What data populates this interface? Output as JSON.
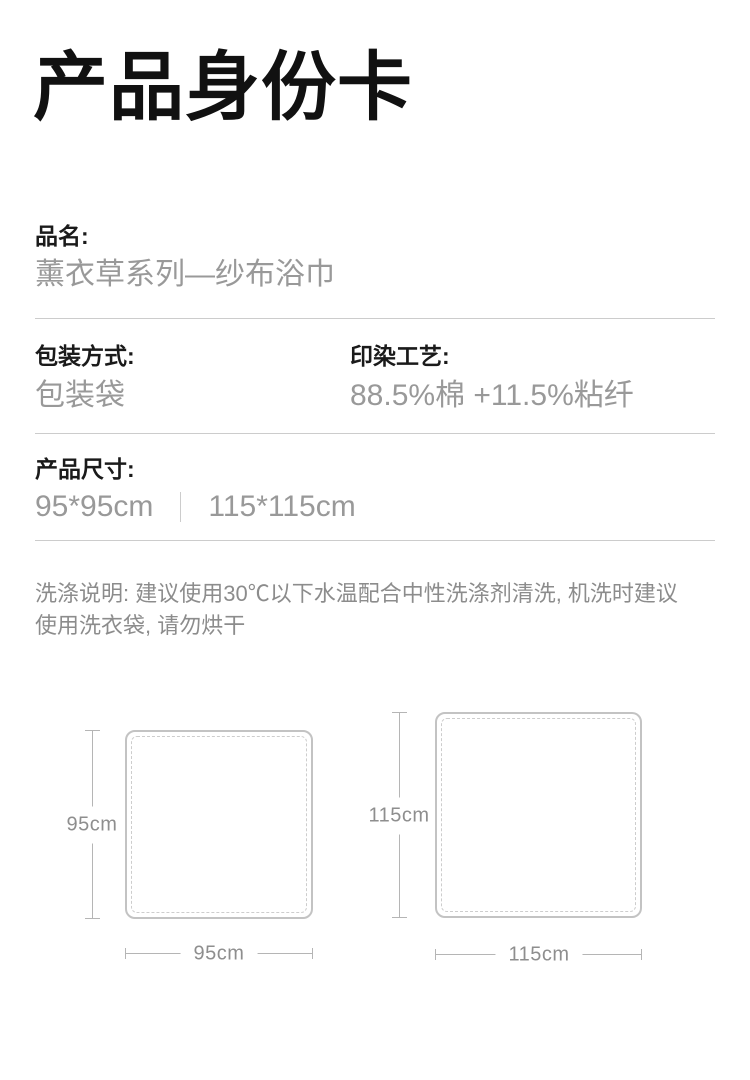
{
  "title": "产品身份卡",
  "fields": {
    "name": {
      "label": "品名:",
      "value": "薰衣草系列—纱布浴巾"
    },
    "packaging": {
      "label": "包装方式:",
      "value": "包装袋"
    },
    "dyeing": {
      "label": "印染工艺:",
      "value": "88.5%棉 +11.5%粘纤"
    },
    "size": {
      "label": "产品尺寸:",
      "value_small": "95*95cm",
      "value_large": "115*115cm"
    }
  },
  "care_note": {
    "line1": "洗涤说明: 建议使用30℃以下水温配合中性洗涤剂清洗, 机洗时建议",
    "line2": "使用洗衣袋, 请勿烘干"
  },
  "diagrams": [
    {
      "name": "towel-95",
      "height_label": "95cm",
      "width_label": "95cm"
    },
    {
      "name": "towel-115",
      "height_label": "115cm",
      "width_label": "115cm"
    }
  ],
  "colors": {
    "heading": "#1a1a1a",
    "value_gray": "#999999",
    "note_gray": "#8c8c8c",
    "divider": "#cccccc",
    "square_outline": "#c3c3c3",
    "measure_line": "#b5b5b5",
    "measure_text": "#8e8e8e"
  }
}
